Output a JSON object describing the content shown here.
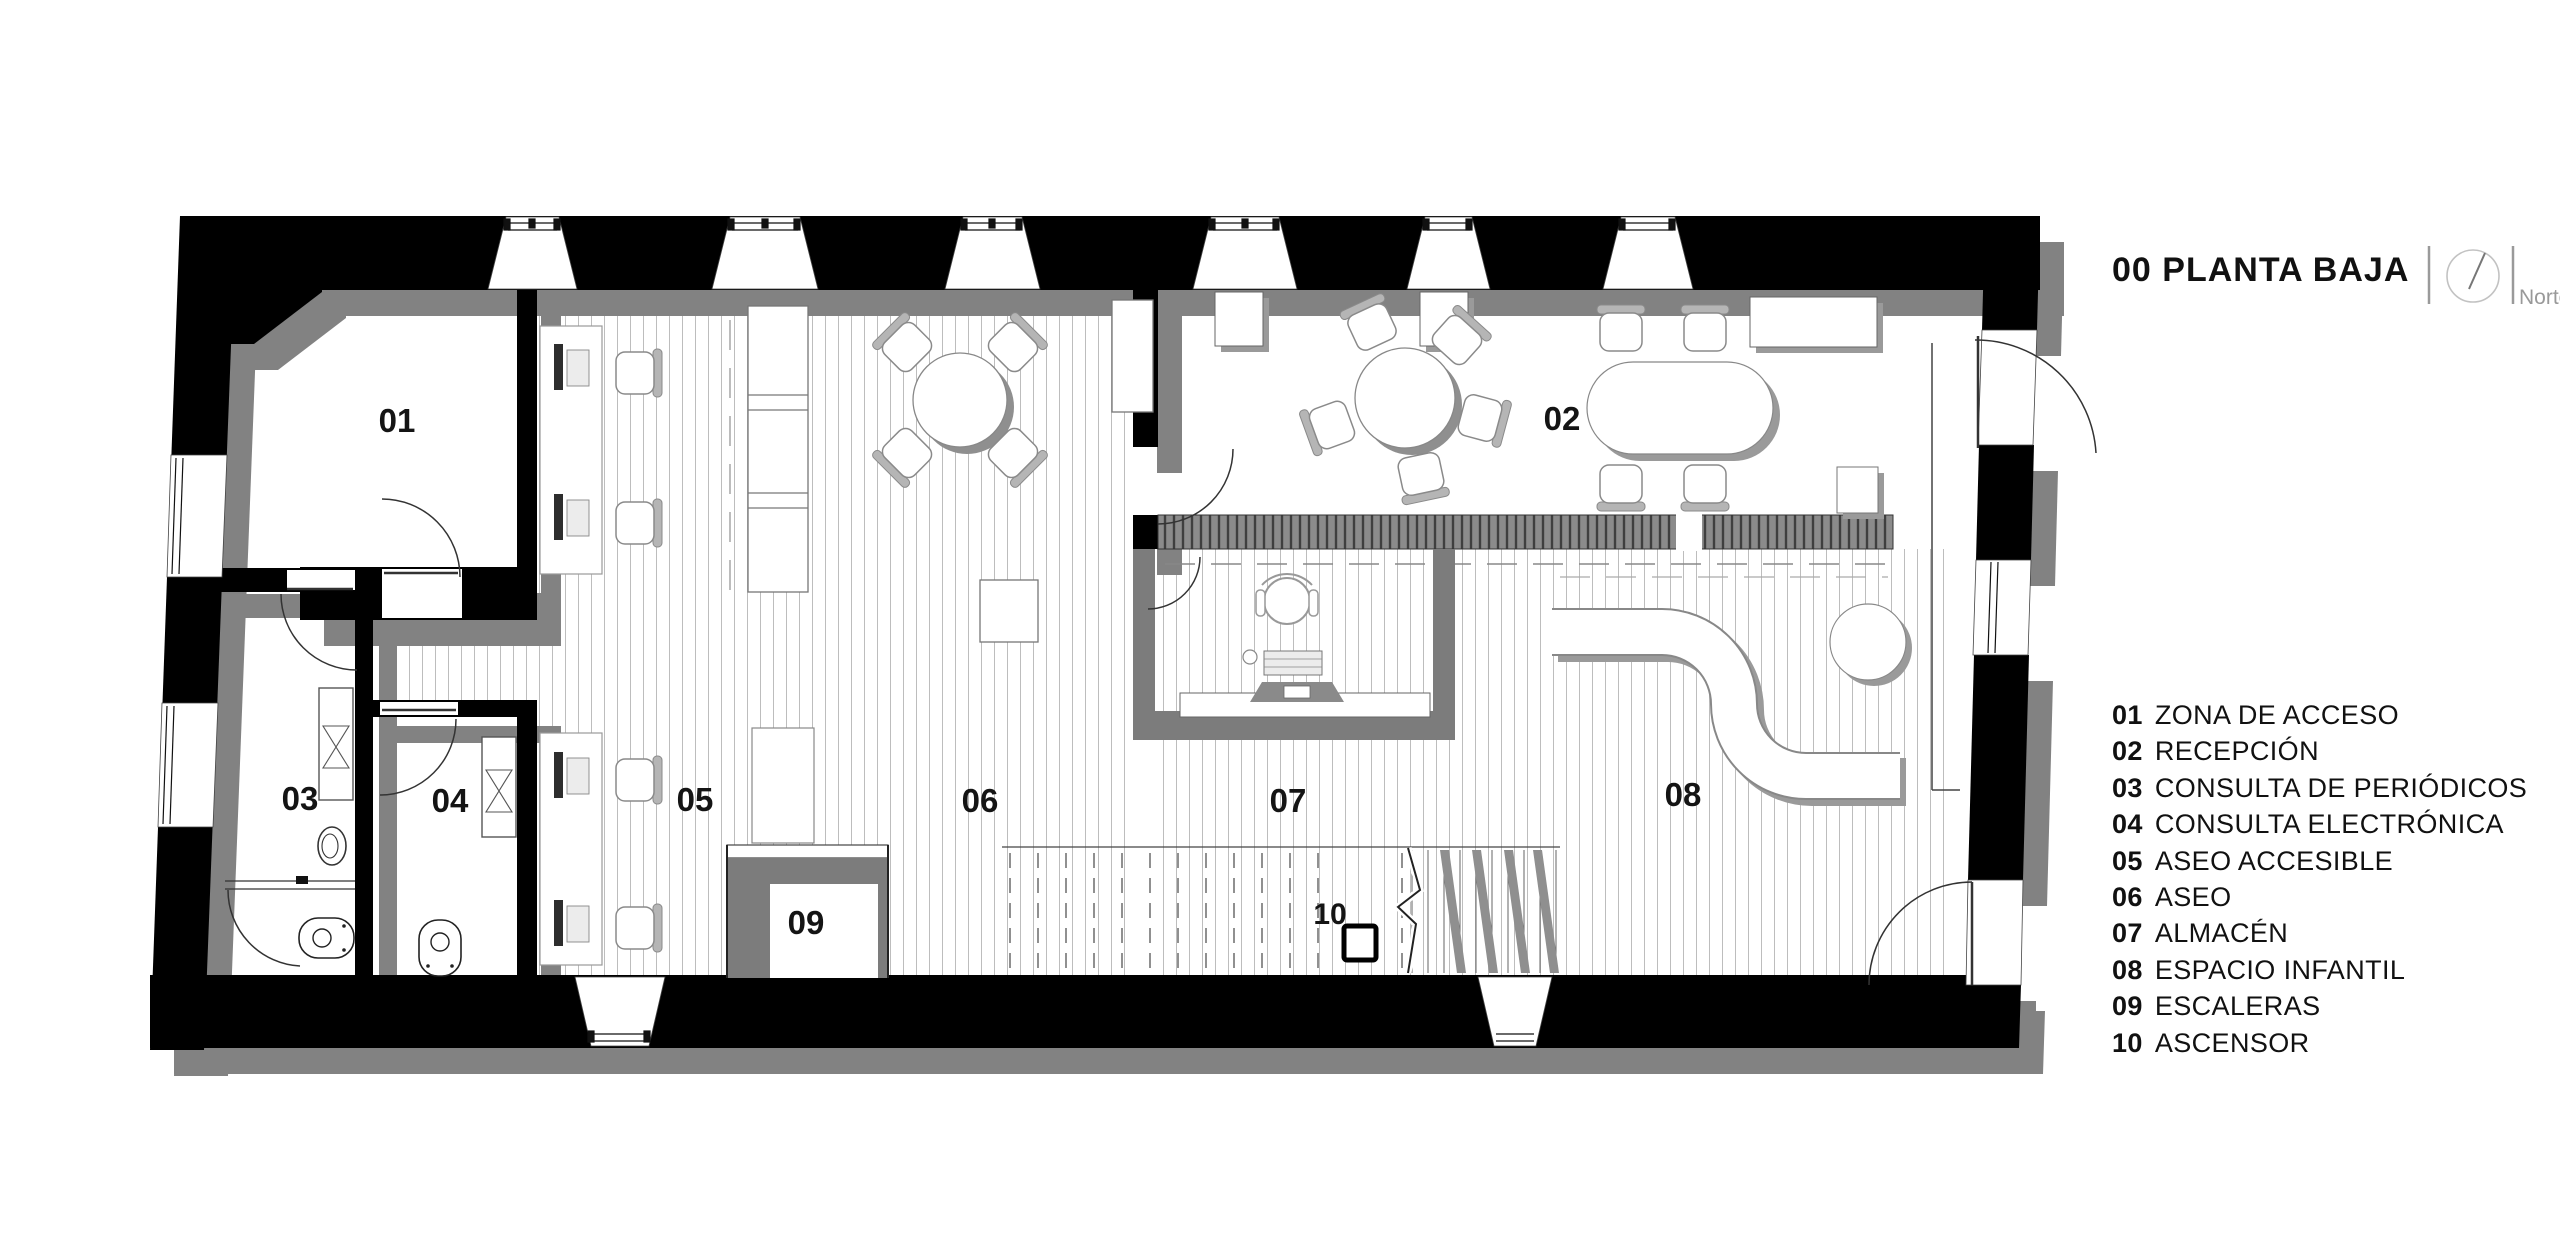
{
  "header": {
    "floor_title": "00 PLANTA BAJA",
    "north_label": "Norte"
  },
  "legend": {
    "items": [
      {
        "number": "01",
        "label": "ZONA DE ACCESO"
      },
      {
        "number": "02",
        "label": "RECEPCIÓN"
      },
      {
        "number": "03",
        "label": "CONSULTA DE PERIÓDICOS"
      },
      {
        "number": "04",
        "label": "CONSULTA ELECTRÓNICA"
      },
      {
        "number": "05",
        "label": "ASEO ACCESIBLE"
      },
      {
        "number": "06",
        "label": "ASEO"
      },
      {
        "number": "07",
        "label": "ALMACÉN"
      },
      {
        "number": "08",
        "label": "ESPACIO INFANTIL"
      },
      {
        "number": "09",
        "label": "ESCALERAS"
      },
      {
        "number": "10",
        "label": "ASCENSOR"
      }
    ]
  },
  "plan": {
    "room_labels": [
      "01",
      "02",
      "03",
      "04",
      "05",
      "06",
      "07",
      "08",
      "09",
      "10"
    ]
  },
  "icons": {
    "north_compass": "north-compass-icon"
  },
  "colors": {
    "wall_black": "#000000",
    "wall_shadow": "#828282",
    "counter_gray": "#7c7c7c",
    "floor_line": "#bdbdbd",
    "furniture_line": "#8a8a8a",
    "text": "#111111",
    "muted_text": "#999999"
  }
}
